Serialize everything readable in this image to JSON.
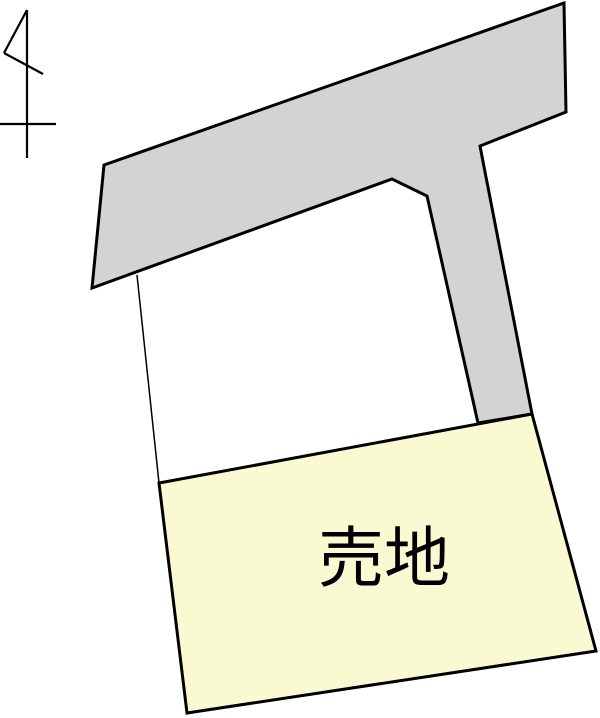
{
  "page": {
    "width": 600,
    "height": 718,
    "background": "#ffffff"
  },
  "colors": {
    "road_fill": "#d3d3d3",
    "plot_fill": "#fafad2",
    "outline": "#000000",
    "label_color": "#000000"
  },
  "labels": {
    "plot_label": "売地"
  },
  "north_arrow": {
    "shaft": "27,10 27,158",
    "flag_upper": "27,10 4,53",
    "flag_lower": "4,53 43,74",
    "crossbar": "0,124 56,124"
  },
  "shapes": {
    "road": {
      "points": "104,165 564,3 566,112 480,146 532,414 478,423 427,196 392,179 92,288"
    },
    "plot_for_sale": {
      "points": "159,483 532,414 596,651 187,713"
    },
    "boundary_line": {
      "points": "137,275 159,483"
    }
  },
  "label_layout": {
    "x": "384",
    "y": "581"
  }
}
